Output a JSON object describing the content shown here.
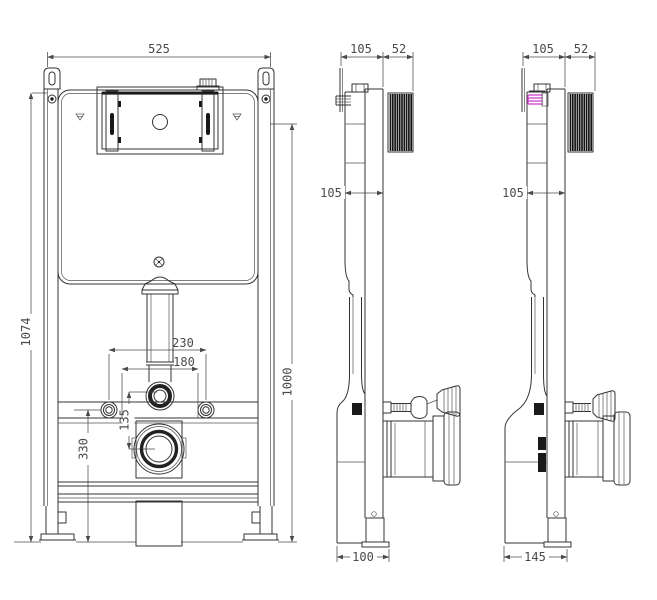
{
  "drawing": {
    "type": "technical-orthographic-drawing",
    "subject": "concealed-cistern-wc-frame",
    "background": "#ffffff",
    "line_color": "#333333",
    "dim_color": "#4a4a4a",
    "highlight_color": "#cf3fcf",
    "views": {
      "front": {
        "dims": {
          "width_top": "525",
          "height_overall": "1074",
          "height_frame": "1000",
          "bolt_spacing": "230",
          "outlet_spacing": "180",
          "flush_to_drain": "135",
          "bolt_height": "330"
        }
      },
      "side_center": {
        "dims": {
          "depth_top": "105",
          "plate_depth": "52",
          "depth_mid": "105",
          "depth_base": "100"
        }
      },
      "side_right": {
        "dims": {
          "depth_top": "105",
          "plate_depth": "52",
          "depth_mid": "105",
          "depth_base": "145"
        }
      }
    }
  }
}
